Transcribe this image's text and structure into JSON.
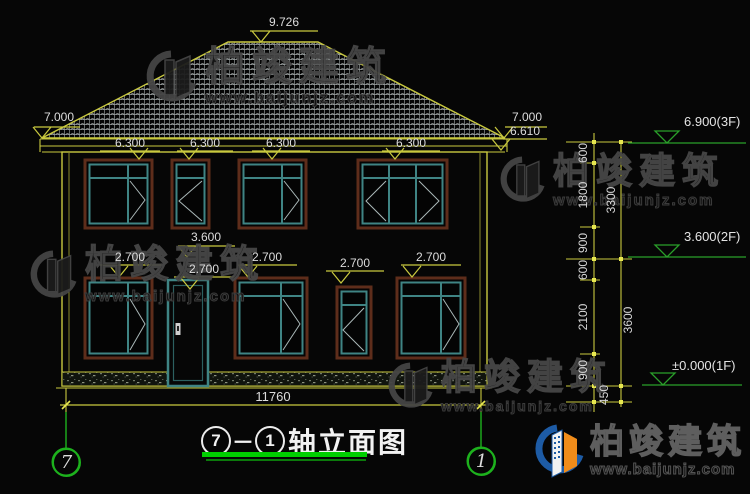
{
  "drawing": {
    "title": {
      "prefix_axis": "7",
      "dash": "－",
      "suffix_axis": "1",
      "text": "轴立面图"
    },
    "axis_bubbles": {
      "left": "7",
      "right": "1"
    },
    "dims": {
      "ridge": "9.726",
      "eave_left": "7.000",
      "eave_right_upper": "7.000",
      "eave_right_lower": "6.610",
      "floor2_heads": [
        "6.300",
        "6.300",
        "6.300",
        "6.300"
      ],
      "mid_label": "3.600",
      "floor1_heads": [
        "2.700",
        "2.700",
        "2.700",
        "2.700",
        "2.700"
      ],
      "total_width": "11760",
      "chain": {
        "inner": [
          "600",
          "1800",
          "900",
          "600",
          "2100",
          "900"
        ],
        "outer": [
          "3300",
          "3600"
        ],
        "foundation": "450"
      }
    },
    "levels": {
      "f3": "6.900(3F)",
      "f2": "3.600(2F)",
      "f1": "±0.000(1F)"
    }
  },
  "watermark": {
    "brand": "柏竣建筑",
    "url": "www.baijunjz.com"
  },
  "colors": {
    "line_yellow": "#c9c93f",
    "tick_yellow": "#e8e850",
    "axis_green": "#1db11d",
    "level_green": "#2aa02a",
    "underline_green": "#00cf00",
    "dim_text": "#dcdcdc",
    "window_teal": "#3f8484",
    "frame_brown": "#5e2d1b",
    "logo_blue": "#1d5ba5",
    "logo_orange": "#f08c1a",
    "background": "#060606"
  }
}
